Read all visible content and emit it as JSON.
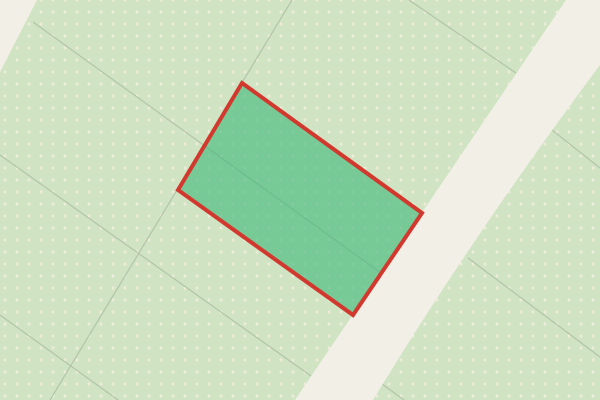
{
  "map": {
    "width": 600,
    "height": 400,
    "colors": {
      "land": "#d0e4c3",
      "dot": "#f2ecdd",
      "boundary_line": "#b2c5a8",
      "road_fill": "#f2efe7",
      "parcel_fill": "rgba(60,184,120,0.6)",
      "parcel_stroke": "#d2382e"
    },
    "dot_grid": {
      "shape": "four-point-sparkle",
      "spacing": 12,
      "offset_x": 11,
      "offset_y": 6
    },
    "roads": [
      {
        "name": "road-main",
        "path": "M 566,0 L 600,0 L 600,65 Q 473,235 373,400 L 295,400 Z"
      },
      {
        "name": "road-corner-top-left",
        "path": "M 0,0 L 37,0 L 0,72 Z"
      }
    ],
    "boundary_lines": [
      {
        "x1": 33,
        "y1": 22,
        "x2": 381,
        "y2": 273
      },
      {
        "x1": 292,
        "y1": 0,
        "x2": 50,
        "y2": 400
      },
      {
        "x1": 0,
        "y1": 155,
        "x2": 311,
        "y2": 376
      },
      {
        "x1": 0,
        "y1": 315,
        "x2": 118,
        "y2": 400
      },
      {
        "x1": 409,
        "y1": 0,
        "x2": 516,
        "y2": 73
      },
      {
        "x1": 552,
        "y1": 130,
        "x2": 600,
        "y2": 168
      },
      {
        "x1": 468,
        "y1": 258,
        "x2": 600,
        "y2": 357
      },
      {
        "x1": 382,
        "y1": 384,
        "x2": 404,
        "y2": 400
      }
    ],
    "selected_parcel": {
      "points": "242,83 422,213 353,315 178,190",
      "stroke_width": 4
    }
  }
}
